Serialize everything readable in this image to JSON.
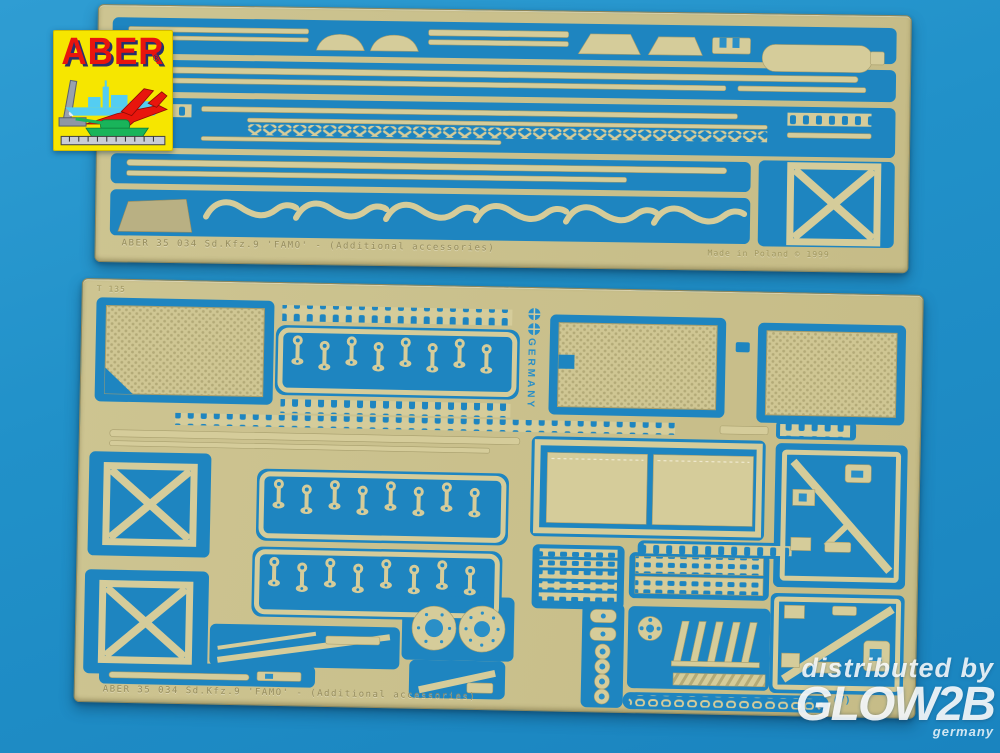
{
  "scene": {
    "background_color": "#2191c9",
    "brass_color": "#c8bf8c",
    "cutout_color": "#1e85c0"
  },
  "logo": {
    "brand": "ABER",
    "registered": "®",
    "bg_color": "#f6e600",
    "text_color": "#e8150d"
  },
  "top_fret": {
    "etched_left": "ABER  35 034  Sd.Kfz.9 'FAMO' - (Additional accessories)",
    "etched_right": "Made in Poland © 1999"
  },
  "bottom_fret": {
    "corner_mark": "T 135",
    "vertical_mark": "GERMANY",
    "circle_mark": "(7)",
    "etched_bottom": "ABER  35 034  Sd.Kfz.9 'FAMO' - (Additional accessories)"
  },
  "watermark": {
    "line1": "distributed by",
    "brand": "GLOW2B",
    "country": "germany"
  }
}
